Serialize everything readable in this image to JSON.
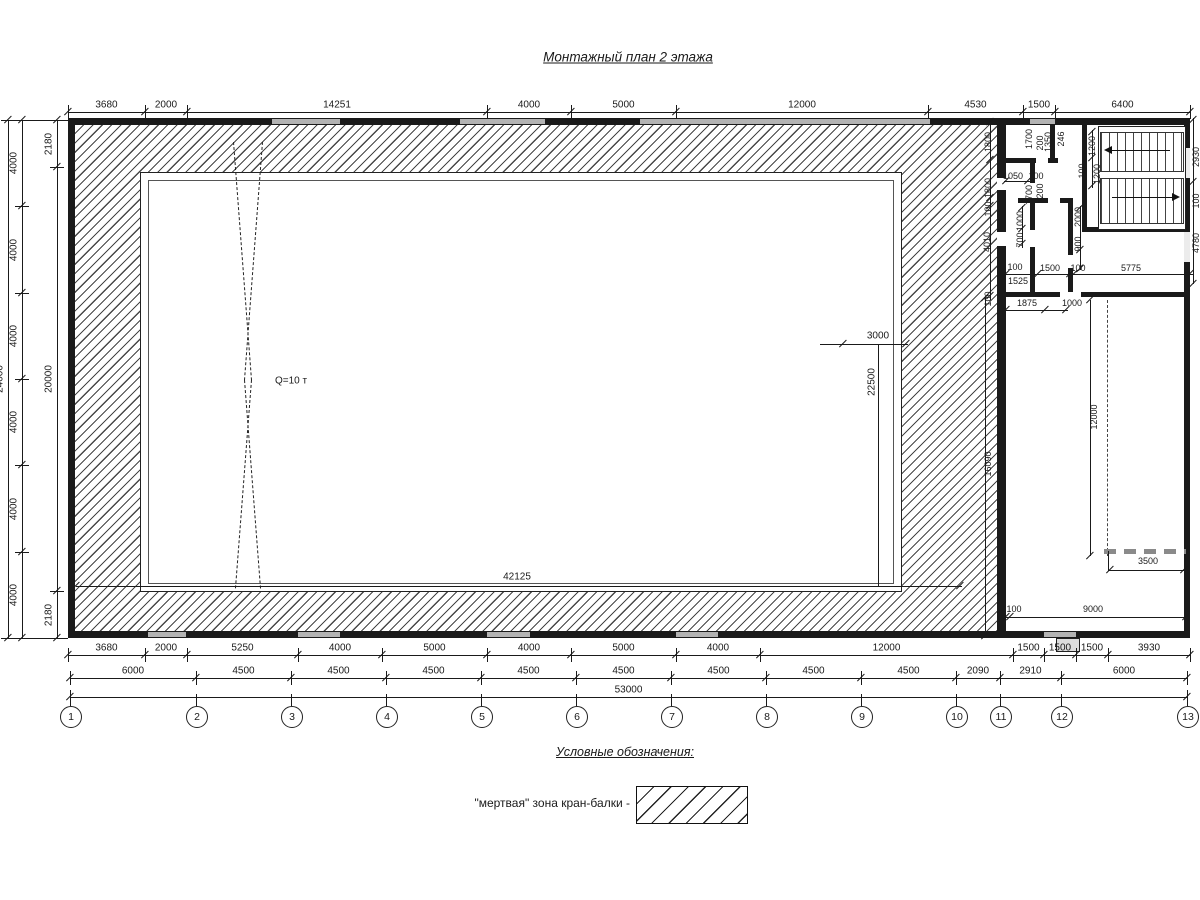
{
  "title": "Монтажный план 2 этажа",
  "dims": {
    "top": [
      "3680",
      "2000",
      "14251",
      "4000",
      "5000",
      "12000",
      "4530",
      "1500",
      "6400"
    ],
    "left_outer": [
      "24000"
    ],
    "left_middle": [
      "4000",
      "4000",
      "4000",
      "4000",
      "4000",
      "4000"
    ],
    "left_inner": [
      "2180",
      "20000",
      "2180"
    ],
    "bottom_row1": [
      "3680",
      "2000",
      "5250",
      "4000",
      "5000",
      "4000",
      "5000",
      "4000",
      "12000",
      "1500",
      "1500",
      "1500",
      "3930"
    ],
    "bottom_row2": [
      "6000",
      "4500",
      "4500",
      "4500",
      "4500",
      "4500",
      "4500",
      "4500",
      "4500",
      "2090",
      "2910",
      "6000"
    ],
    "bottom_total": [
      "53000"
    ]
  },
  "axes": [
    "1",
    "2",
    "3",
    "4",
    "5",
    "6",
    "7",
    "8",
    "9",
    "10",
    "11",
    "12",
    "13"
  ],
  "annotations": [
    "1800",
    "1800",
    "1700",
    "200",
    "1350",
    "246",
    "1200",
    "1200",
    "2930",
    "1050",
    "100",
    "100",
    "1700",
    "200",
    "1000",
    "700",
    "2000",
    "900",
    "4010",
    "100",
    "100",
    "100",
    "1525",
    "1500",
    "100",
    "5775",
    "1875",
    "1000",
    "100",
    "4780",
    "16090",
    "12000",
    "3500",
    "100",
    "9000",
    "3000",
    "22500",
    "42125",
    "Q=10 т"
  ],
  "legend": {
    "heading": "Условные обозначения:",
    "dead_zone_label": "\"мертвая\" зона кран-балки -"
  },
  "colors": {
    "line": "#1a1a1a",
    "wall_gray": "#b3b3b3",
    "hatch": "#2b2b2b"
  }
}
